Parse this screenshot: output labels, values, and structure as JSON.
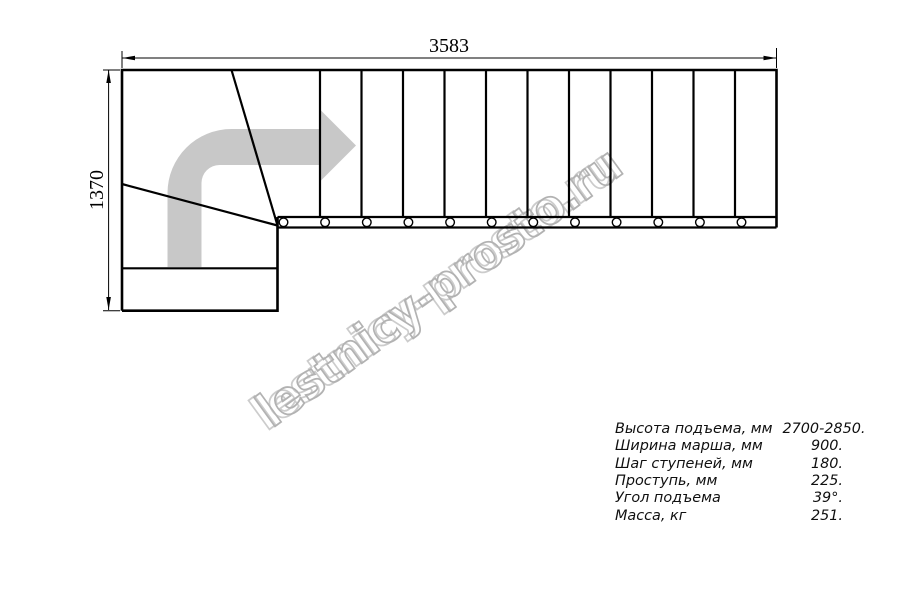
{
  "drawing": {
    "title": "staircase-top-view-plan",
    "dimensions": {
      "width": "3583",
      "height": "1370"
    },
    "straight_tread_line_count": 11,
    "baluster_count": 12,
    "colors": {
      "line": "#000000",
      "arrow_gray": "#c8c8c8",
      "watermark_gray": "#b2b2b2"
    }
  },
  "watermark": {
    "text": "lestnicy-prosto.ru"
  },
  "specs": {
    "rows": [
      {
        "label": "Высота подъема, мм",
        "value": "2700-2850."
      },
      {
        "label": "Ширина марша, мм",
        "value": "900."
      },
      {
        "label": "Шаг ступеней, мм",
        "value": "180."
      },
      {
        "label": "Проступь, мм",
        "value": "225."
      },
      {
        "label": "Угол подъема",
        "value": "39°."
      },
      {
        "label": "Масса, кг",
        "value": "251."
      }
    ]
  }
}
